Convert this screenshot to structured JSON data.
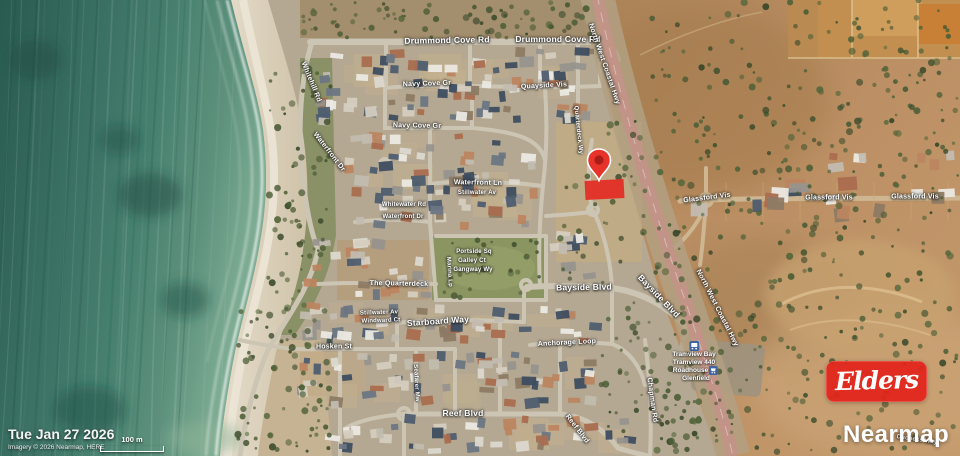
{
  "branding": {
    "agency_logo_text": "Elders",
    "imagery_provider": "Nearmap"
  },
  "overlay": {
    "date": "Tue Jan 27 2026",
    "attribution": "Imagery © 2026 Nearmap, HERE",
    "scale_label": "100 m"
  },
  "marker": {
    "type": "property-pin",
    "pin_color": "#e8332b",
    "parcel_highlight_color": "#e23128"
  },
  "colors": {
    "ocean": "#41776a",
    "sand": "#d7cdb9",
    "suburb_ground": "#b5a892",
    "rural_ground": "#b98c60",
    "park_green": "#8b9562",
    "road": "#cdc5b4",
    "highway": "#c29387",
    "label_text": "#ffffff"
  },
  "map": {
    "street_labels": [
      {
        "text": "Drummond Cove Rd",
        "x": 447,
        "y": 40,
        "rot": -1,
        "size": "m"
      },
      {
        "text": "Drummond Cove Rd",
        "x": 558,
        "y": 39,
        "rot": 0,
        "size": "m"
      },
      {
        "text": "North West Coastal Hwy",
        "x": 604,
        "y": 64,
        "rot": 71,
        "size": "s"
      },
      {
        "text": "Whitehill Rd",
        "x": 311,
        "y": 82,
        "rot": 68,
        "size": "s"
      },
      {
        "text": "Navy Cove Gr",
        "x": 427,
        "y": 84,
        "rot": -2,
        "size": "s"
      },
      {
        "text": "Quayside Vis",
        "x": 544,
        "y": 86,
        "rot": -3,
        "size": "s"
      },
      {
        "text": "Navy Cove Gr",
        "x": 417,
        "y": 126,
        "rot": 1,
        "size": "s"
      },
      {
        "text": "Quarterdeck Wy",
        "x": 578,
        "y": 130,
        "rot": 84,
        "size": "xs"
      },
      {
        "text": "Waterfront Dr",
        "x": 329,
        "y": 152,
        "rot": 52,
        "size": "s"
      },
      {
        "text": "Waterfront Ln",
        "x": 478,
        "y": 183,
        "rot": 1,
        "size": "s"
      },
      {
        "text": "Stillwater Av",
        "x": 477,
        "y": 193,
        "rot": 0,
        "size": "xs"
      },
      {
        "text": "Whitewater Rd",
        "x": 404,
        "y": 205,
        "rot": 0,
        "size": "xs"
      },
      {
        "text": "Waterfront Dr",
        "x": 403,
        "y": 217,
        "rot": 0,
        "size": "xs"
      },
      {
        "text": "Marina Lp",
        "x": 449,
        "y": 272,
        "rot": 86,
        "size": "xs"
      },
      {
        "text": "Portside Sq",
        "x": 474,
        "y": 252,
        "rot": 0,
        "size": "xs"
      },
      {
        "text": "Galley Ct",
        "x": 472,
        "y": 261,
        "rot": 0,
        "size": "xs"
      },
      {
        "text": "Gangway Wy",
        "x": 473,
        "y": 270,
        "rot": 0,
        "size": "xs"
      },
      {
        "text": "The Quarterdeck",
        "x": 399,
        "y": 284,
        "rot": 1,
        "size": "s"
      },
      {
        "text": "Bayside Blvd",
        "x": 584,
        "y": 287,
        "rot": -1,
        "size": "m"
      },
      {
        "text": "Bayside Blvd",
        "x": 659,
        "y": 296,
        "rot": 46,
        "size": "m"
      },
      {
        "text": "Glassford Vis",
        "x": 707,
        "y": 198,
        "rot": -7,
        "size": "s"
      },
      {
        "text": "Glassford Vis",
        "x": 829,
        "y": 198,
        "rot": 0,
        "size": "s"
      },
      {
        "text": "Glassford Vis",
        "x": 915,
        "y": 197,
        "rot": 0,
        "size": "s"
      },
      {
        "text": "Stillwater Av",
        "x": 379,
        "y": 313,
        "rot": -2,
        "size": "xs"
      },
      {
        "text": "Windward Ct",
        "x": 381,
        "y": 321,
        "rot": -2,
        "size": "xs"
      },
      {
        "text": "Starboard Way",
        "x": 438,
        "y": 321,
        "rot": -4,
        "size": "m"
      },
      {
        "text": "Hosken St",
        "x": 334,
        "y": 347,
        "rot": 0,
        "size": "s"
      },
      {
        "text": "Anchorage Loop",
        "x": 567,
        "y": 343,
        "rot": -3,
        "size": "s"
      },
      {
        "text": "Seafarer Mw",
        "x": 416,
        "y": 383,
        "rot": 87,
        "size": "xs"
      },
      {
        "text": "Reef Blvd",
        "x": 463,
        "y": 413,
        "rot": 0,
        "size": "m"
      },
      {
        "text": "Reef Blvd",
        "x": 577,
        "y": 429,
        "rot": 52,
        "size": "s"
      },
      {
        "text": "Chapman Rd",
        "x": 652,
        "y": 400,
        "rot": 82,
        "size": "s"
      },
      {
        "text": "North West Coastal Hwy",
        "x": 717,
        "y": 308,
        "rot": 63,
        "size": "s"
      },
      {
        "text": "Duchess Way",
        "x": 917,
        "y": 440,
        "rot": 8,
        "size": "xs"
      }
    ],
    "poi_labels": [
      {
        "icon": "bus-icon",
        "icon_pos": "top",
        "lines": [
          "Tramview Bay",
          "Tramview 440"
        ],
        "x": 694,
        "y": 341
      },
      {
        "icon": "store-icon",
        "icon_pos": "inline",
        "lines": [
          "Roadhouse",
          "Glenfield"
        ],
        "x": 696,
        "y": 366
      }
    ]
  }
}
